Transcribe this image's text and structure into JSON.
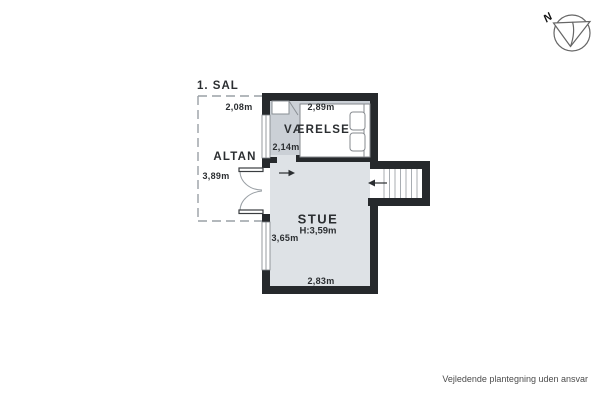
{
  "page": {
    "footer_disclaimer": "Vejledende plantegning uden ansvar"
  },
  "floorplan": {
    "floor_label": "1. SAL",
    "compass_label": "N",
    "rooms": {
      "vaerelse": {
        "name": "VÆRELSE",
        "width": "2,89m",
        "depth": "2,14m"
      },
      "stue": {
        "name": "STUE",
        "ceiling_height": "H:3,59m",
        "depth": "3,65m",
        "width": "2,83m"
      },
      "altan": {
        "name": "ALTAN",
        "width": "2,08m",
        "length": "3,89m"
      }
    },
    "features": [
      "staircase",
      "double-bed",
      "balcony-double-door",
      "windows",
      "closet"
    ],
    "colors": {
      "wall": "#26292c",
      "stue_floor": "#dee2e6",
      "vaerelse_floor": "#cbd0d6",
      "outline_gray": "#9aa0a5",
      "footer_text": "#4c4c4c"
    }
  }
}
